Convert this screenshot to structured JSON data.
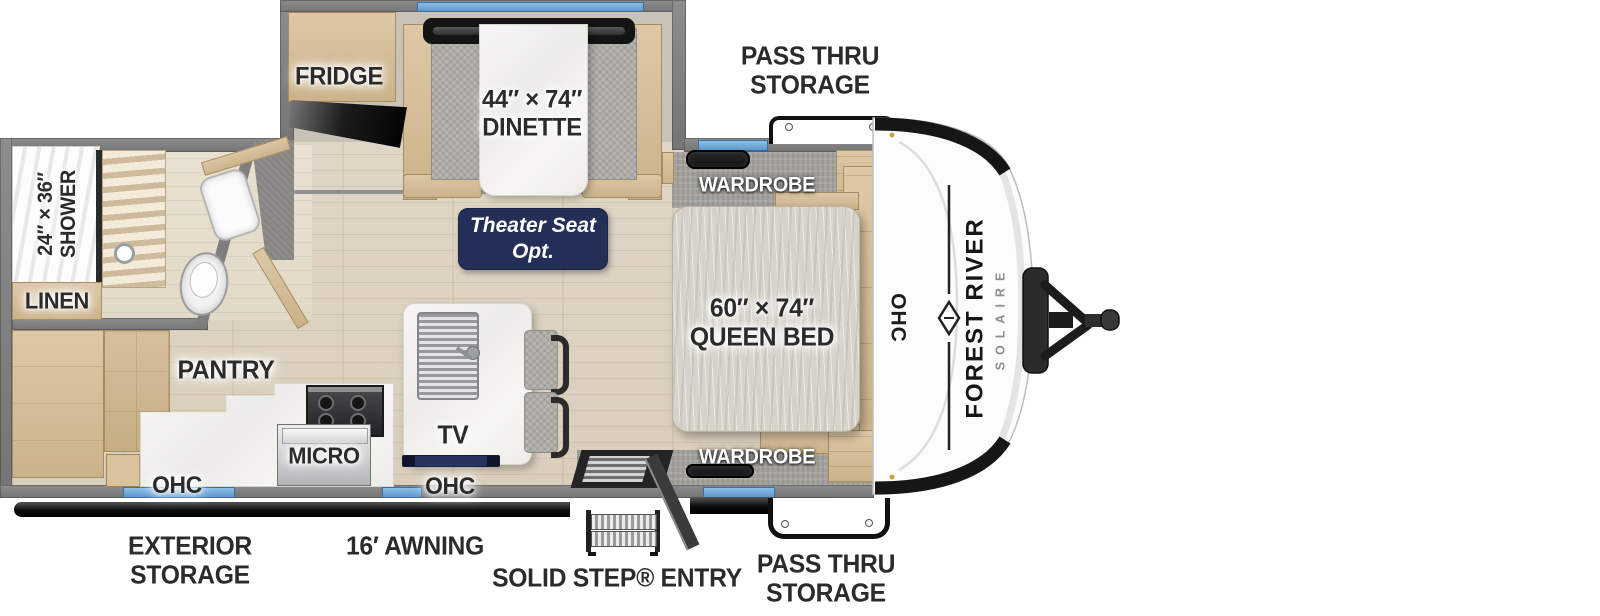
{
  "fp": {
    "front_cap": {
      "brand": "FOREST RIVER",
      "model": "SOLAIRE",
      "ohc": "OHC"
    },
    "labels": {
      "pass_thru_top": [
        "PASS THRU",
        "STORAGE"
      ],
      "fridge": "FRIDGE",
      "dinette": [
        "44″ × 74″",
        "DINETTE"
      ],
      "wardrobe_top": "WARDROBE",
      "theater_seat": [
        "Theater Seat",
        "Opt."
      ],
      "queen_bed": [
        "60″ × 74″",
        "QUEEN BED"
      ],
      "shower": [
        "24″ × 36″",
        "SHOWER"
      ],
      "linen": "LINEN",
      "pantry": "PANTRY",
      "micro": "MICRO",
      "tv": "TV",
      "ohc_left": "OHC",
      "ohc_kitchen": "OHC",
      "wardrobe_bottom": "WARDROBE",
      "exterior_storage": [
        "EXTERIOR",
        "STORAGE"
      ],
      "awning": "16′ AWNING",
      "entry": "SOLID STEP® ENTRY",
      "pass_thru_bottom": [
        "PASS THRU",
        "STORAGE"
      ]
    },
    "colors": {
      "label_text": "#2b2b2b",
      "badge_navy": "#242f58",
      "window_blue": "#6fa8d8",
      "wall_gray": "#818181",
      "cabinet_tan": "#d7c19e",
      "floor_wood": "#ddd3c2",
      "counter_marble": "#f3f2ee",
      "awning_black": "#151515",
      "cap_white": "#fcfcfc"
    }
  }
}
